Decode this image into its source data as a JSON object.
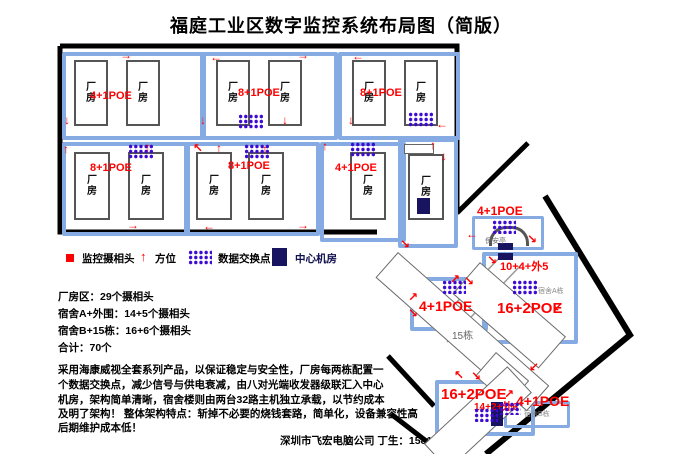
{
  "title": "福庭工业区数字监控系统布局图（简版）",
  "factory": {
    "building_label": "厂\n房",
    "blocks": [
      {
        "poe": "4+1POE"
      },
      {
        "poe": "8+1POE"
      },
      {
        "poe": "8+1POE"
      },
      {
        "poe": "8+1POE"
      },
      {
        "poe": "8+1POE"
      },
      {
        "poe": "4+1POE"
      }
    ]
  },
  "legend": {
    "camera": "监控摄相头",
    "direction": "方位",
    "switch": "数据交换点",
    "server_room": "中心机房"
  },
  "stats": {
    "line1": "厂房区：29个摄相头",
    "line2": "宿舍A+外围：14+5个摄相头",
    "line3": "宿舍B+15栋：16+6个摄相头",
    "line4": "合计：70个"
  },
  "description": {
    "line1": "采用海康威视全套系列产品，以保证稳定与安全性，厂房每两栋配置一",
    "line2": "个数据交换点，减少信号与供电衰减，由八对光端收发器级联汇入中心",
    "line3": "机房，架构简单清晰，宿舍楼则由两台32路主机独立承载，以节约成本",
    "line4": "及明了架构！ 整体架构特点：斩掉不必要的烧钱套路，简单化，设备兼容性高",
    "line5": "后期维护成本低！"
  },
  "signature": "深圳市飞宏电脑公司 丁生：15818511571",
  "site": {
    "guard": {
      "poe": "4+1POE",
      "name": "保安亭"
    },
    "dorm_a": {
      "poe_outer": "10+4+外5",
      "poe": "16+2POE",
      "name": "宿舍A栋"
    },
    "mid_block": {
      "poe": "4+1POE"
    },
    "b15": "15栋",
    "small_house": "小平房",
    "dorm_b": {
      "poe": "16+2POE",
      "poe_detail": "14+2+外6",
      "poe_right": "4+1POE",
      "name": "宿舍B栋"
    }
  },
  "glyphs": {
    "up": "↑",
    "down": "↓",
    "left": "←",
    "right": "→",
    "up_left": "↖",
    "up_right": "↗",
    "down_left": "↙",
    "down_right": "↘"
  },
  "colors": {
    "accent_red": "#ff0000",
    "block_blue": "#86abe3",
    "switch_purple": "#3d0ad1",
    "server_navy": "#191460"
  }
}
